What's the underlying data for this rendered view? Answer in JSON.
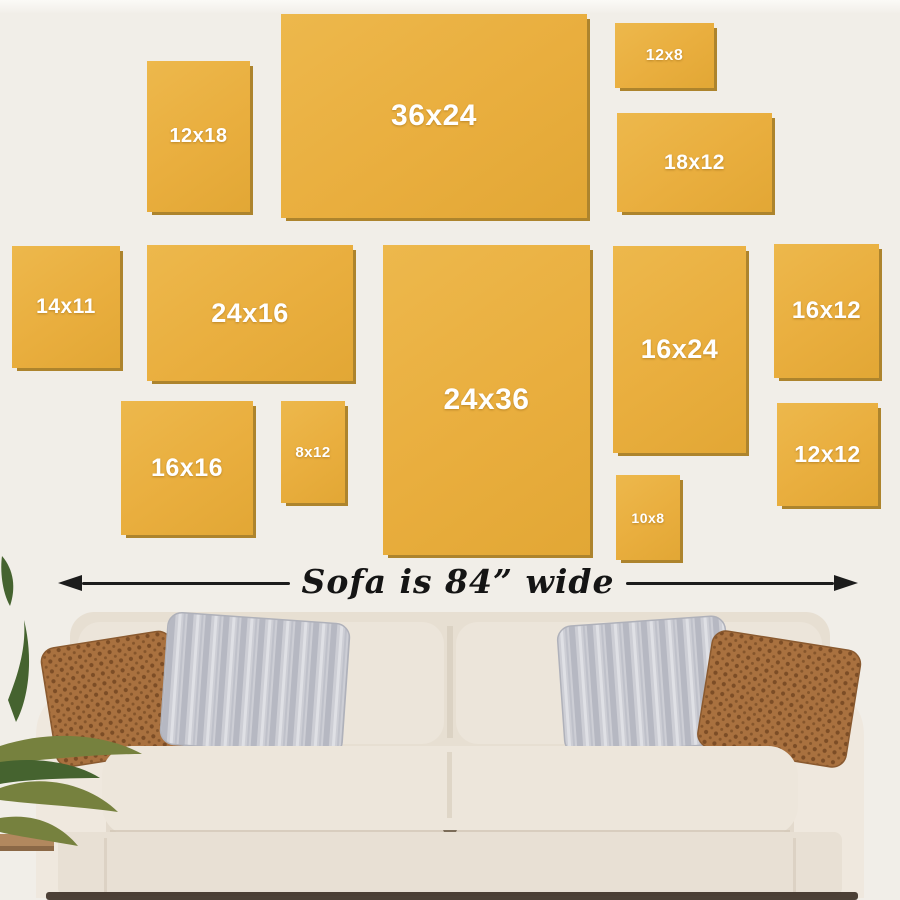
{
  "colors": {
    "wall": "#F1EEE8",
    "wall-top": "#FBFAF7",
    "frame": "#E9AE3E",
    "frame-light": "#EDB84C",
    "frame-shadow": "#AD842D",
    "frame-label": "#FFFFFF",
    "arrow": "#1C1C1C",
    "caption": "#151515",
    "sofa-body": "#ECE5DA",
    "sofa-base": "#E8E0D4",
    "pillow-brown": "#A9713F",
    "pillow-brown-dot": "#7C4D26",
    "pillow-gray": "#CDCED5",
    "pillow-gray-stripe": "#B6B8C2",
    "plant-green": "#76813E",
    "plant-dark": "#45632F",
    "floor-wood": "#B2885E",
    "floor-shadow": "#3A2D24"
  },
  "frames": [
    {
      "label": "12x18",
      "x": 147,
      "y": 61,
      "w": 103,
      "h": 151,
      "font": 20
    },
    {
      "label": "36x24",
      "x": 281,
      "y": 14,
      "w": 306,
      "h": 204,
      "font": 30
    },
    {
      "label": "12x8",
      "x": 615,
      "y": 23,
      "w": 99,
      "h": 65,
      "font": 16
    },
    {
      "label": "18x12",
      "x": 617,
      "y": 113,
      "w": 155,
      "h": 99,
      "font": 21
    },
    {
      "label": "14x11",
      "x": 12,
      "y": 246,
      "w": 108,
      "h": 122,
      "font": 21
    },
    {
      "label": "24x16",
      "x": 147,
      "y": 245,
      "w": 206,
      "h": 136,
      "font": 27
    },
    {
      "label": "24x36",
      "x": 383,
      "y": 245,
      "w": 207,
      "h": 310,
      "font": 30
    },
    {
      "label": "16x24",
      "x": 613,
      "y": 246,
      "w": 133,
      "h": 207,
      "font": 27
    },
    {
      "label": "16x12",
      "x": 774,
      "y": 244,
      "w": 105,
      "h": 134,
      "font": 24
    },
    {
      "label": "16x16",
      "x": 121,
      "y": 401,
      "w": 132,
      "h": 134,
      "font": 25
    },
    {
      "label": "8x12",
      "x": 281,
      "y": 401,
      "w": 64,
      "h": 102,
      "font": 15
    },
    {
      "label": "10x8",
      "x": 616,
      "y": 475,
      "w": 64,
      "h": 85,
      "font": 14
    },
    {
      "label": "12x12",
      "x": 777,
      "y": 403,
      "w": 101,
      "h": 103,
      "font": 23
    }
  ],
  "measurement": {
    "caption": "Sofa is 84” wide",
    "icons": {
      "arrowhead-left": "css-triangle-left",
      "arrowhead-right": "css-triangle-right"
    }
  }
}
